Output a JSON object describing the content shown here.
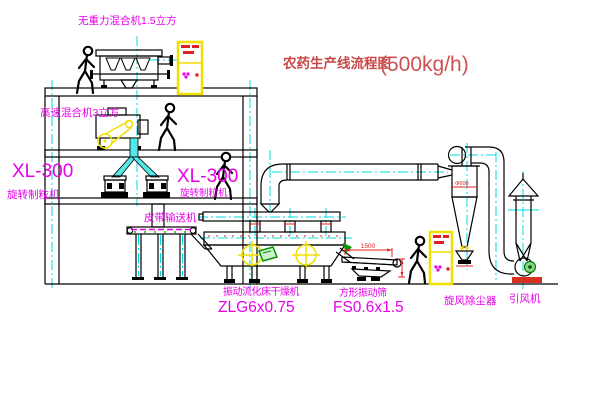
{
  "diagram": {
    "title": {
      "text": "农药生产线流程图",
      "capacity": "(500kg/h)"
    },
    "labels": {
      "gravity_mixer": "无重力混合机1.5立方",
      "high_speed_mixer": "高速混合机3立方",
      "granulator_left_model": "XL-300",
      "granulator_left_name": "旋转制粒机",
      "granulator_right_model": "XL-300",
      "granulator_right_name": "旋转制粒机",
      "belt_conveyor": "皮带输送机",
      "dryer_name": "振动流化床干燥机",
      "dryer_model": "ZLG6x0.75",
      "screen_name": "方形振动筛",
      "screen_model": "FS0.6x1.5",
      "cyclone": "旋风除尘器",
      "fan": "引风机"
    },
    "dimensions": {
      "screen_length": "1500",
      "cyclone_dia": "Φ600"
    },
    "colors": {
      "label_magenta": "#E800E8",
      "title_red": "#C84848",
      "dimension_red": "#E02020",
      "centerline_cyan": "#00DCDC",
      "cabinet_yellow": "#F0E000",
      "motor_green": "#009600",
      "line_black": "#000000"
    }
  }
}
